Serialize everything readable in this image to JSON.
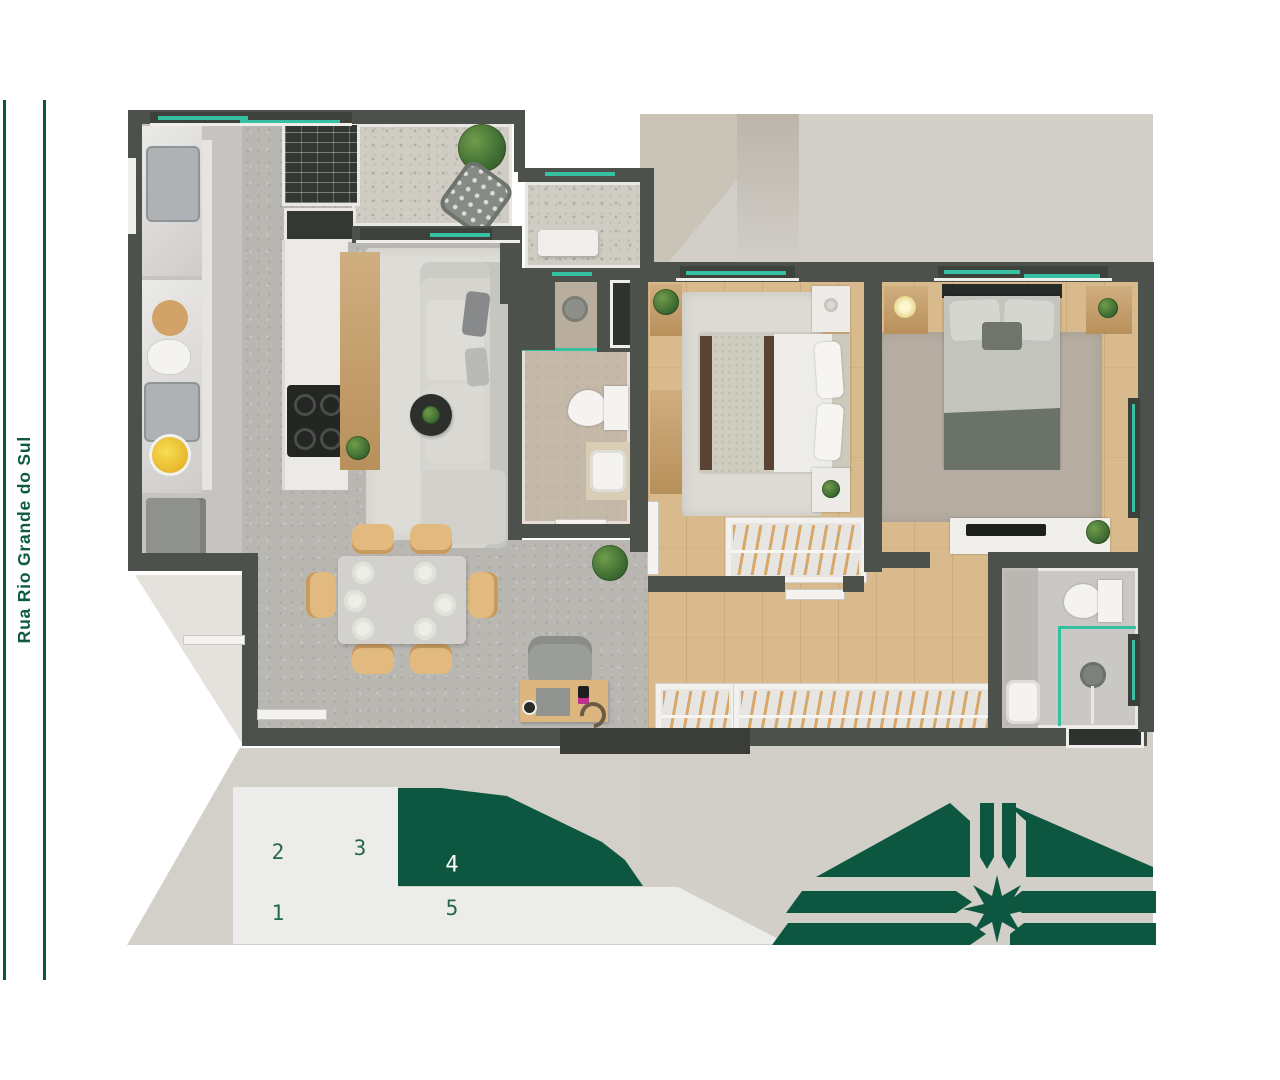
{
  "street": {
    "label": "Rua Rio Grande do Sul"
  },
  "keyplan": {
    "units": [
      {
        "label": "1",
        "highlighted": false
      },
      {
        "label": "2",
        "highlighted": false
      },
      {
        "label": "3",
        "highlighted": false
      },
      {
        "label": "4",
        "highlighted": true
      },
      {
        "label": "5",
        "highlighted": false
      }
    ],
    "highlighted_unit_label": "4"
  },
  "compass": {
    "name": "compass-rose"
  },
  "palette": {
    "accent_green": "#0d5740",
    "street_text_green": "#0d5c42",
    "wall_dark": "#4d514c",
    "band_gray": "#d2cfc9",
    "keyplan_light": "#ececeb",
    "wood": "#d9ba8c",
    "concrete": "#b9b7b2",
    "terrazzo": "#cfccc3",
    "glass_teal": "#2fae92"
  }
}
